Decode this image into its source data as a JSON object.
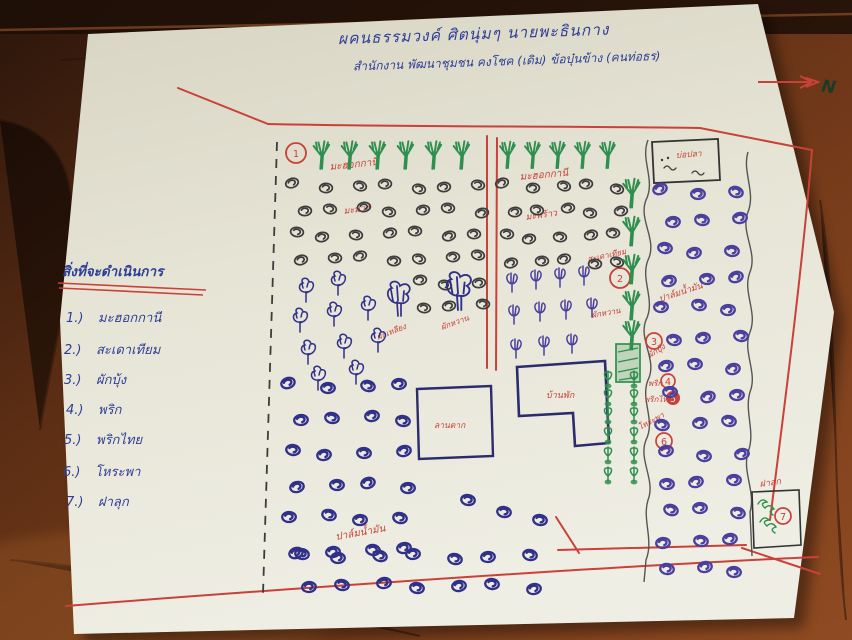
{
  "ink_colors": {
    "red": "#c94138",
    "blue": "#2e3e96",
    "green": "#2f8f4e",
    "black": "#3c3c3c",
    "purple": "#4a3f9e",
    "paper": "#e7e5d6",
    "wood": "#5c2e14"
  },
  "title": {
    "line1": "ผคนธรรมวงค์ ศิตนุ่มๆ นายพะธินกาง",
    "line2": "สำนักงาน พัฒนาชุมชน คงโชค (เดิม) ข้อบุ๋นข้าง (คนท่อธร)"
  },
  "compass": {
    "label": "N"
  },
  "legend": {
    "heading": "สิ่งที่จะดำเนินการ",
    "items": [
      {
        "no": "1.)",
        "label": "มะฮอกกานี"
      },
      {
        "no": "2.)",
        "label": "สะเดาเทียม"
      },
      {
        "no": "3.)",
        "label": "ผักบุ้ง"
      },
      {
        "no": "4.)",
        "label": "พริก"
      },
      {
        "no": "5.)",
        "label": "พริกไทย"
      },
      {
        "no": "6.)",
        "label": "โหระพา"
      },
      {
        "no": "7.)",
        "label": "ฝาลุก"
      }
    ]
  },
  "map": {
    "markers": [
      "1",
      "2",
      "3",
      "4",
      "5",
      "6",
      "7"
    ],
    "labels": {
      "zoneA_trees": "มะฮอกกานี",
      "zoneA_crop": "มะม่วง",
      "zoneA_tree_left": "ผักเหลียง",
      "zoneA_tree_right": "ผักหวาน",
      "zoneB_crop": "ปาล์มน้ำมัน",
      "zoneC_trees": "มะฮอกกานี",
      "zoneC_crop": "มะพร้าว",
      "hedge": "สะเดาเทียม",
      "hedge_lower": "ผักหวาน",
      "veg_morning_glory": "ผักบุ้ง",
      "veg_chili": "พริก",
      "veg_pepper": "พริกไทย",
      "veg_basil": "โหระพา",
      "palm_right": "ปาล์มน้ำมัน",
      "plot7": "ฝาลุก",
      "fish_pond": "บ่อปลา",
      "house": "บ้านพัก",
      "drying_yard": "ลานตาก"
    }
  }
}
